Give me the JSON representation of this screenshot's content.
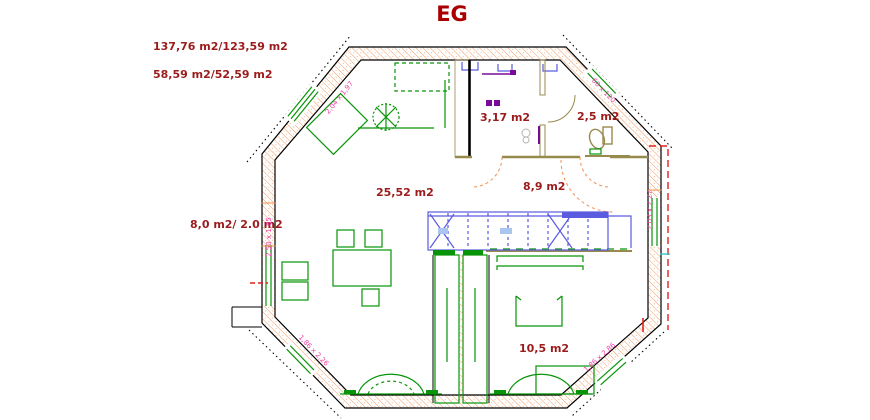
{
  "title": "EG",
  "colors": {
    "title_text": "#aa0000",
    "area_text": "#9b1c1c",
    "dimension_text": "#ee3fa4",
    "wall_hatch": "#ef8e4f",
    "furniture_green": "#089408",
    "kitchen_blue": "#5b5be0",
    "kitchen_light_blue": "#aac6f0",
    "interior_wall_tan": "#978a4d",
    "fixture_purple": "#7a0b9a",
    "overhang_red": "#e02020",
    "tick_aqua": "#3cc3c3"
  },
  "labels": {
    "total_area": "137,76 m2/123,59 m2",
    "secondary_area": "58,59 m2/52,59 m2",
    "utility_room": "3,17 m2",
    "wc": "2,5 m2",
    "living_room": "25,52 m2",
    "kitchen": "8,9 m2",
    "balcony": "8,0 m2/ 2.0 m2",
    "bedroom": "10,5 m2"
  },
  "dimensions": {
    "top_left_wall": "2,04 x 1,97",
    "left_wall": "2,50 x 1,85",
    "top_right_wall": "60 x 120",
    "right_wall": "2,03 x 2,27",
    "bottom_right_wall": "1,86 x 2,86",
    "bottom_left_wall": "1,86 x 2,26"
  }
}
